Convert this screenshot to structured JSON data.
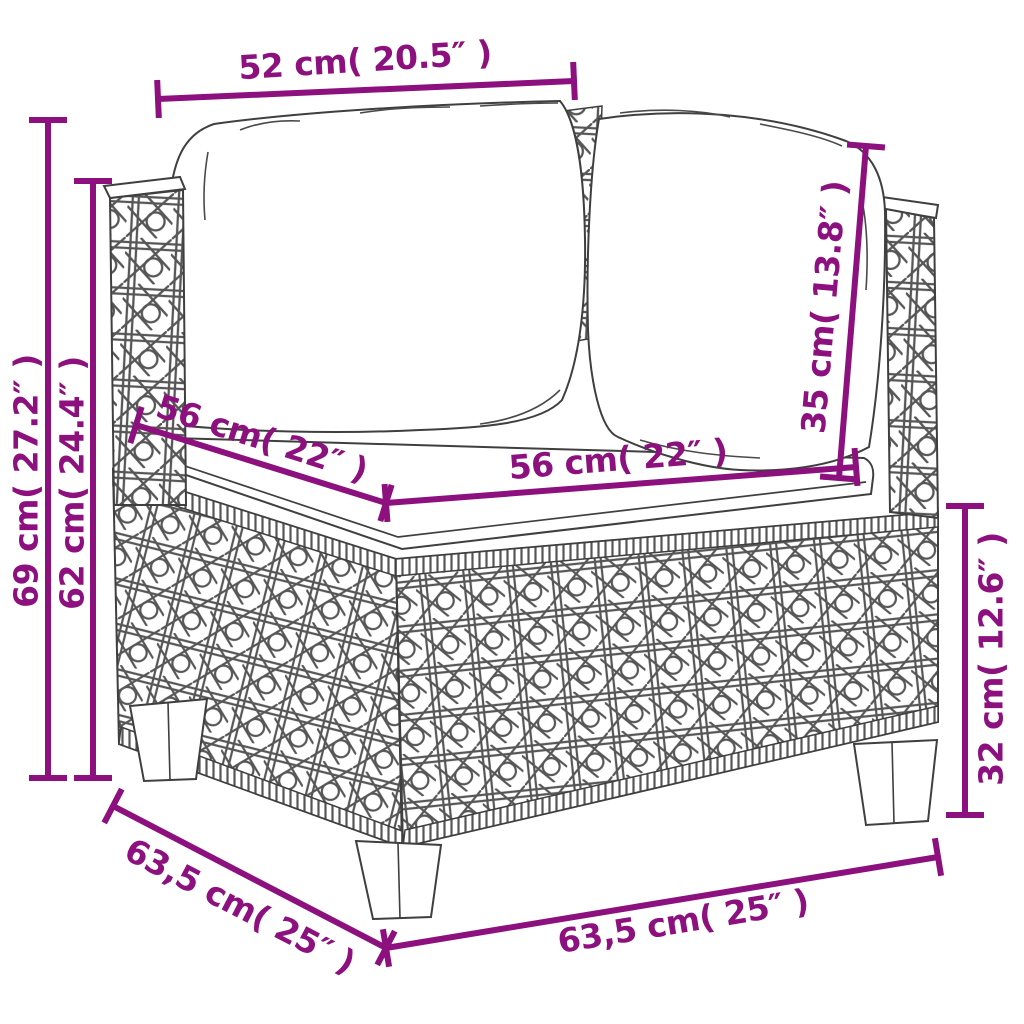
{
  "page": {
    "type": "product-dimension-diagram",
    "subject": "poly rattan corner sofa section with back cushions and seat cushion, line drawing with measurements",
    "background": "#ffffff"
  },
  "style": {
    "dimension_color": "#8C107E",
    "art_outline_color": "#3f3f3f",
    "weave_color": "#565656",
    "font_size": 33,
    "line_width": 6,
    "tick_half_length": 19
  },
  "artwork_parts": [
    "left-back-cushion",
    "right-back-cushion",
    "seat-cushion",
    "left-wicker-post",
    "right-wicker-post",
    "wicker-body-left-face",
    "wicker-body-front-face",
    "sofa-leg"
  ],
  "dimensions": [
    {
      "id": "back-width-top",
      "label": "52 cm( 20.5″ )",
      "x1": 158,
      "y1": 99,
      "x2": 574,
      "y2": 81,
      "label_x": 365,
      "label_y": 60,
      "label_rotate": -3.5
    },
    {
      "id": "height-overall",
      "label": "69 cm( 27.2″ )",
      "x1": 48,
      "y1": 120,
      "x2": 48,
      "y2": 778,
      "label_x": 26,
      "label_y": 481,
      "label_rotate": -90
    },
    {
      "id": "height-back-post",
      "label": "62 cm( 24.4″ )",
      "x1": 93,
      "y1": 181,
      "x2": 93,
      "y2": 778,
      "label_x": 72,
      "label_y": 483,
      "label_rotate": -90
    },
    {
      "id": "seat-depth",
      "label": "56 cm( 22″ )",
      "x1": 136,
      "y1": 425,
      "x2": 386,
      "y2": 503,
      "label_x": 262,
      "label_y": 438,
      "label_rotate": 17.5
    },
    {
      "id": "seat-width",
      "label": "56 cm( 22″ )",
      "x1": 386,
      "y1": 503,
      "x2": 856,
      "y2": 467,
      "label_x": 618,
      "label_y": 459,
      "label_rotate": -4.5
    },
    {
      "id": "back-cushion-height",
      "label": "35 cm( 13.8″ )",
      "x1": 866,
      "y1": 146,
      "x2": 839,
      "y2": 478,
      "label_x": 824,
      "label_y": 307,
      "label_rotate": -85
    },
    {
      "id": "base-height",
      "label": "32 cm( 12.6″ )",
      "x1": 965,
      "y1": 506,
      "x2": 965,
      "y2": 815,
      "label_x": 991,
      "label_y": 659,
      "label_rotate": -90
    },
    {
      "id": "base-depth-bottom",
      "label": "63,5 cm( 25″ )",
      "x1": 113,
      "y1": 806,
      "x2": 386,
      "y2": 948,
      "label_x": 240,
      "label_y": 906,
      "label_rotate": 27.5
    },
    {
      "id": "base-width-bottom",
      "label": "63,5 cm( 25″ )",
      "x1": 386,
      "y1": 948,
      "x2": 938,
      "y2": 857,
      "label_x": 683,
      "label_y": 921,
      "label_rotate": -9.4
    }
  ]
}
